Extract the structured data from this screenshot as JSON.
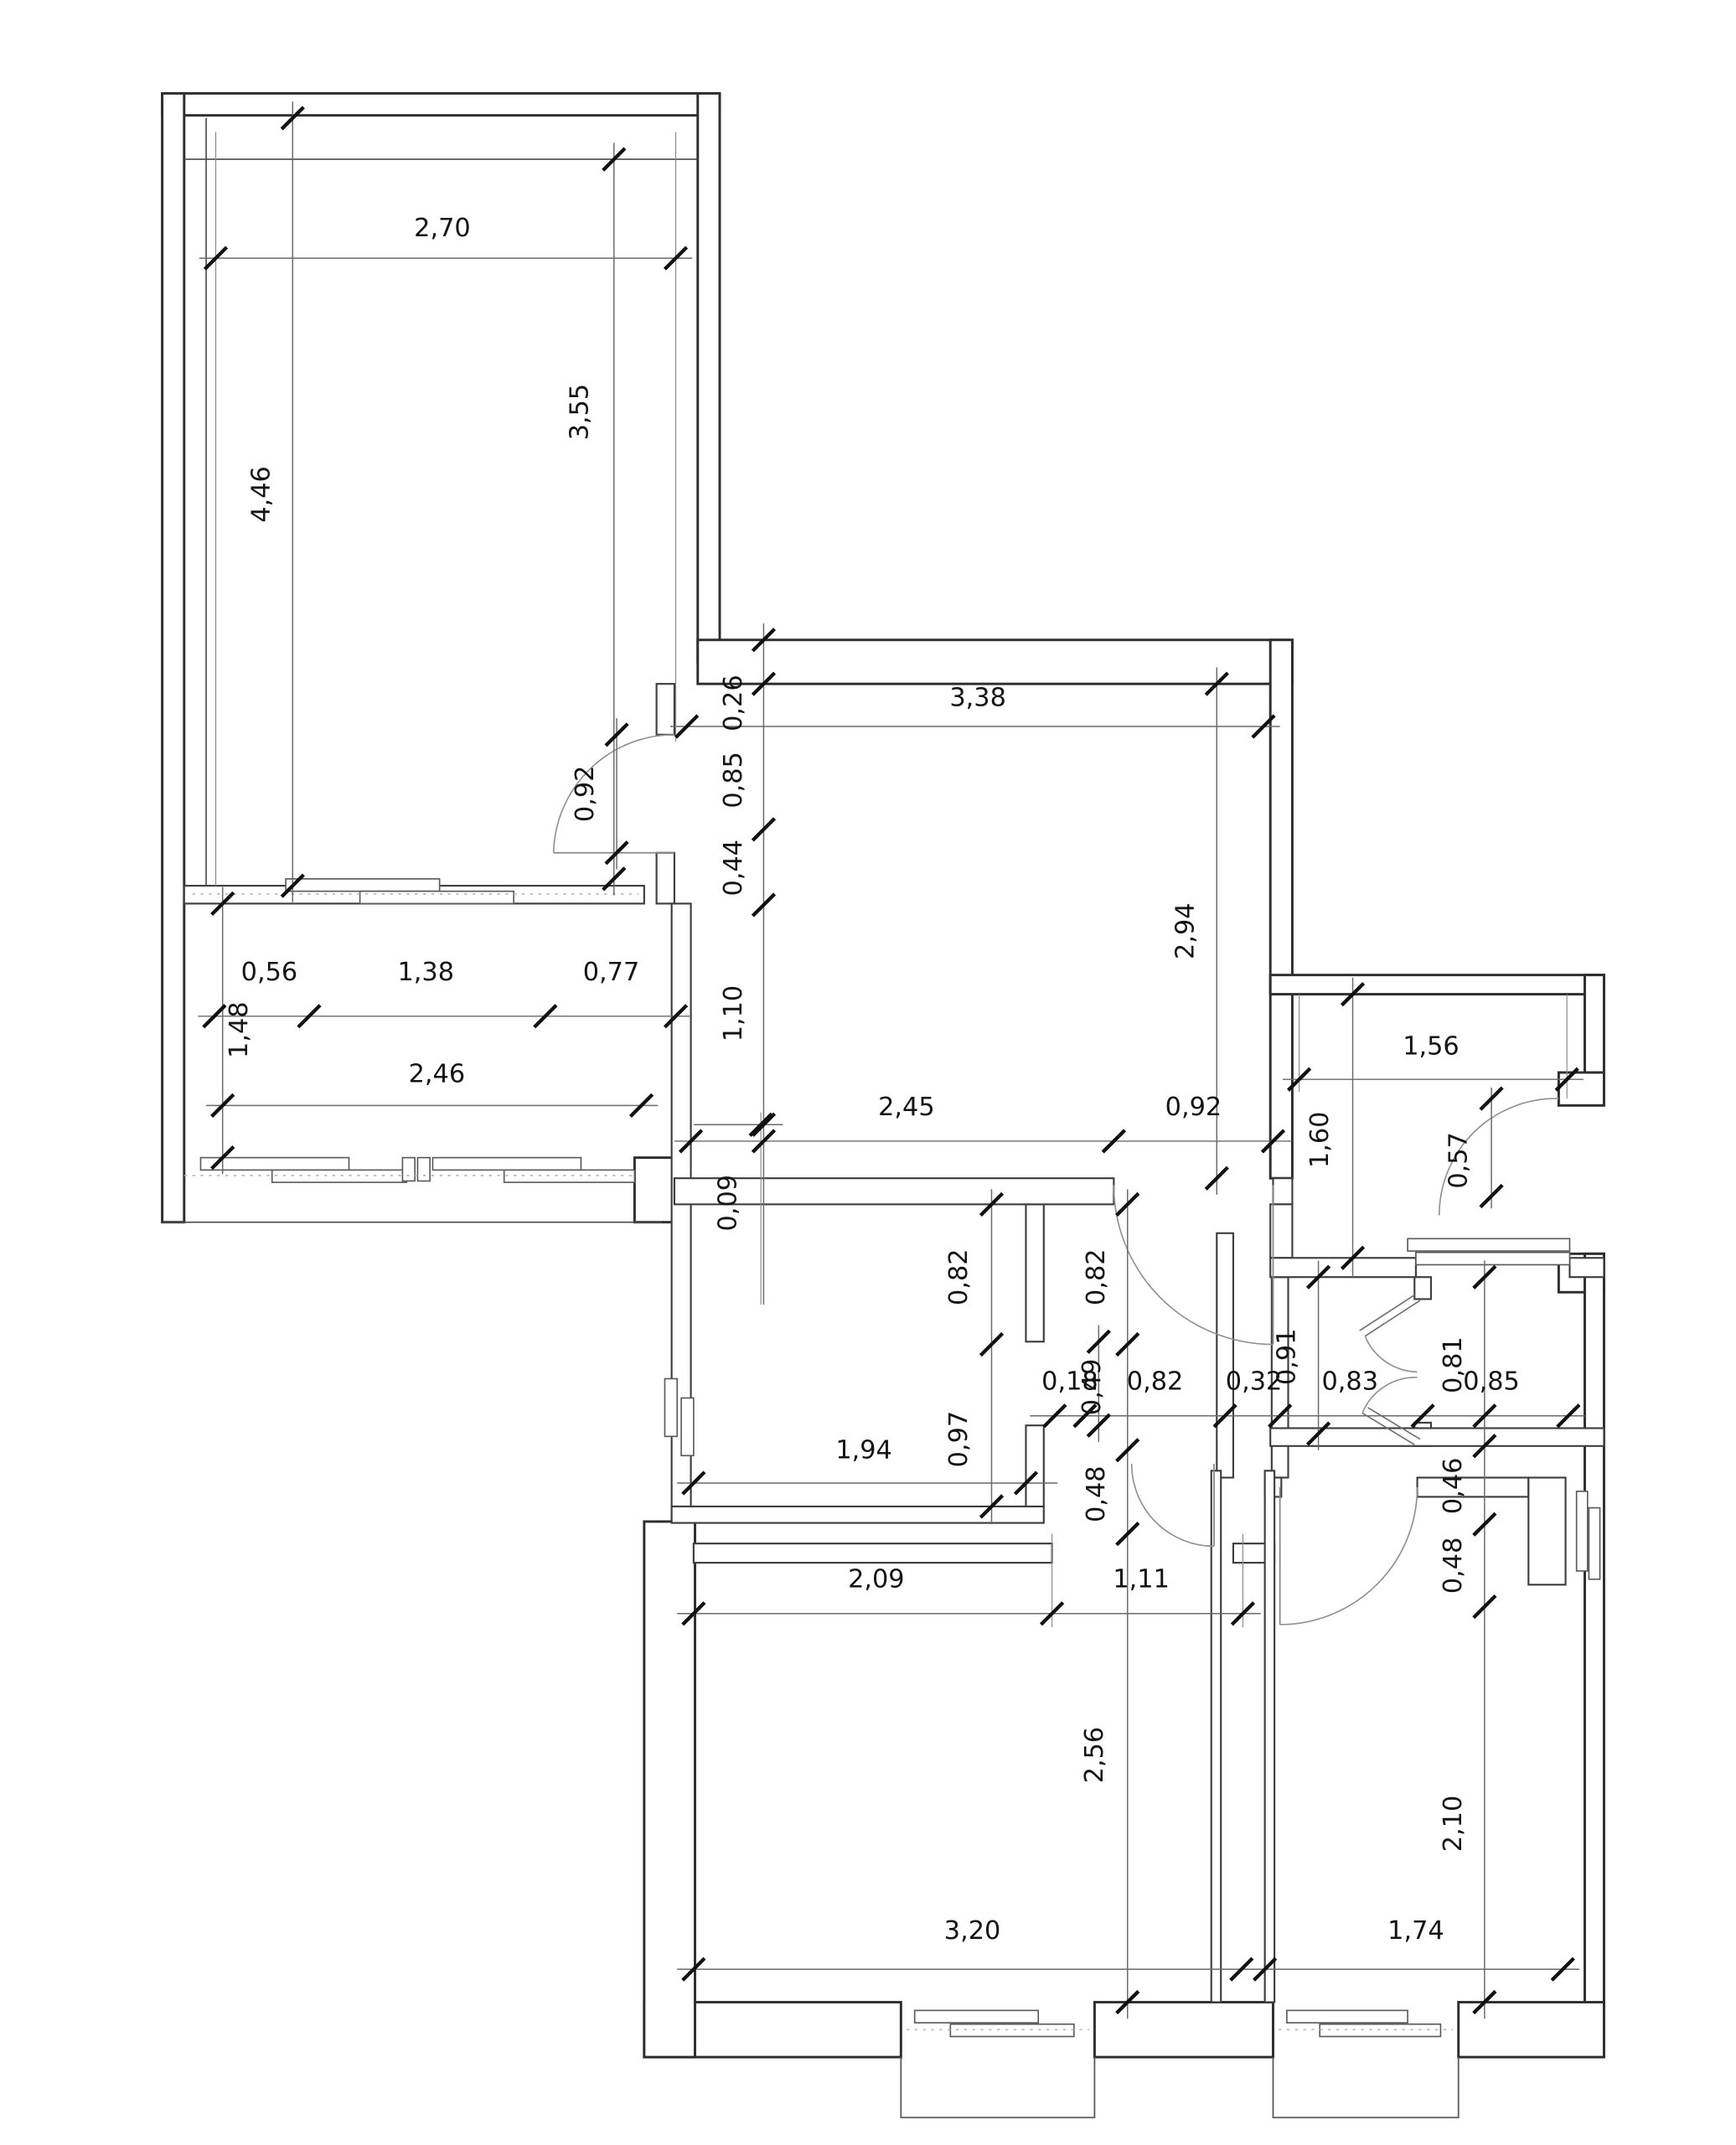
{
  "plan": {
    "dims": [
      "2,70",
      "4,46",
      "3,55",
      "0,26",
      "3,38",
      "0,92",
      "0,85",
      "0,44",
      "0,56",
      "1,38",
      "0,77",
      "2,94",
      "1,48",
      "1,10",
      "2,46",
      "1,56",
      "2,45",
      "0,92",
      "1,60",
      "0,57",
      "0,09",
      "0,82",
      "0,82",
      "0,91",
      "0,81",
      "0,18",
      "0,49",
      "0,82",
      "0,32",
      "0,83",
      "0,85",
      "0,97",
      "1,94",
      "0,48",
      "0,46",
      "0,48",
      "2,09",
      "1,11",
      "2,56",
      "2,10",
      "3,20",
      "1,74"
    ]
  }
}
